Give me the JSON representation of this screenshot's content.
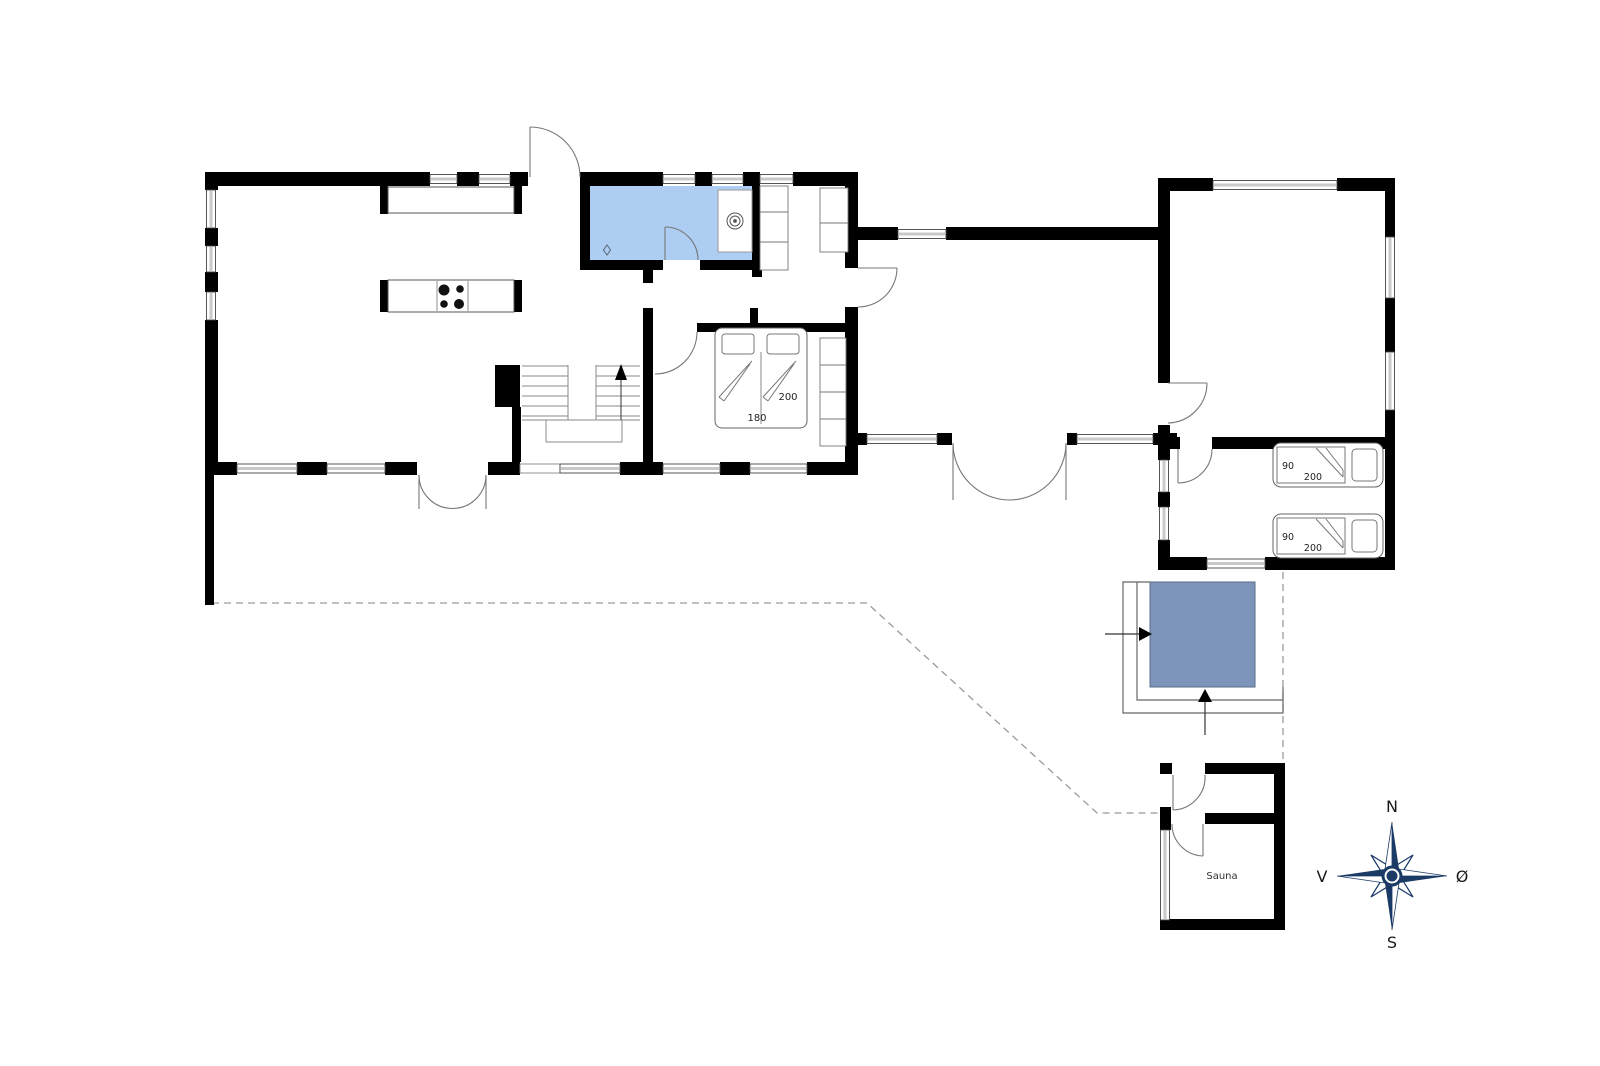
{
  "plan": {
    "rooms": {
      "bathroom": {
        "fill": "#aecdf2"
      },
      "sauna": {
        "label": "Sauna"
      }
    },
    "beds": {
      "double": {
        "width_label": "180",
        "length_label": "200"
      },
      "single_1": {
        "width_label": "90",
        "length_label": "200"
      },
      "single_2": {
        "width_label": "90",
        "length_label": "200"
      }
    },
    "hot_tub": {
      "fill": "#7d95ba",
      "edge": "#5a6c87"
    },
    "compass": {
      "n": "N",
      "s": "S",
      "w": "V",
      "e": "Ø",
      "color": "#1b3a66",
      "label_color": "#1a1a1a"
    }
  }
}
